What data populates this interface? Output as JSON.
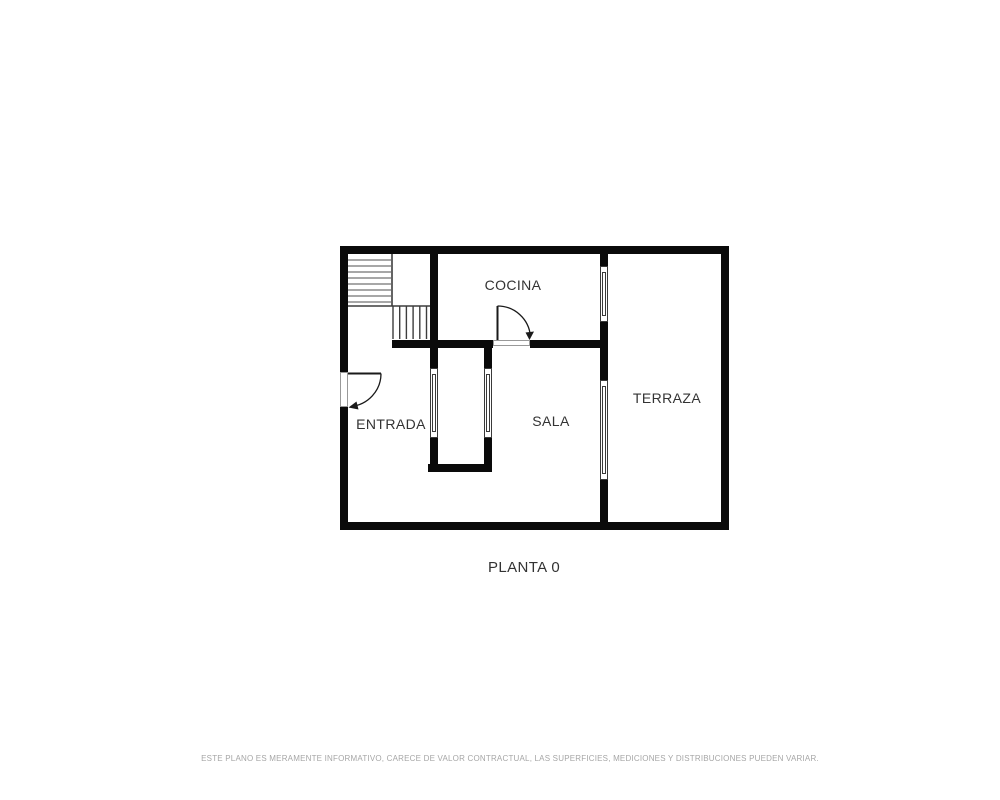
{
  "plan": {
    "title": "PLANTA 0",
    "rooms": [
      {
        "id": "cocina",
        "label": "COCINA"
      },
      {
        "id": "terraza",
        "label": "TERRAZA"
      },
      {
        "id": "entrada",
        "label": "ENTRADA"
      },
      {
        "id": "sala",
        "label": "SALA"
      }
    ],
    "disclaimer": "ESTE PLANO ES MERAMENTE INFORMATIVO, CARECE DE VALOR CONTRACTUAL, LAS SUPERFICIES, MEDICIONES Y DISTRIBUCIONES PUEDEN VARIAR.",
    "colors": {
      "wall": "#0a0a0a",
      "label": "#333333",
      "disclaimer": "#a6a6a6",
      "background": "#ffffff",
      "tread_light": "#8a8a8a",
      "tread_dark": "#3d3d3d",
      "window_stroke": "#3a3a3a",
      "threshold_stroke": "#999999",
      "door_line": "#1a1a1a"
    }
  }
}
